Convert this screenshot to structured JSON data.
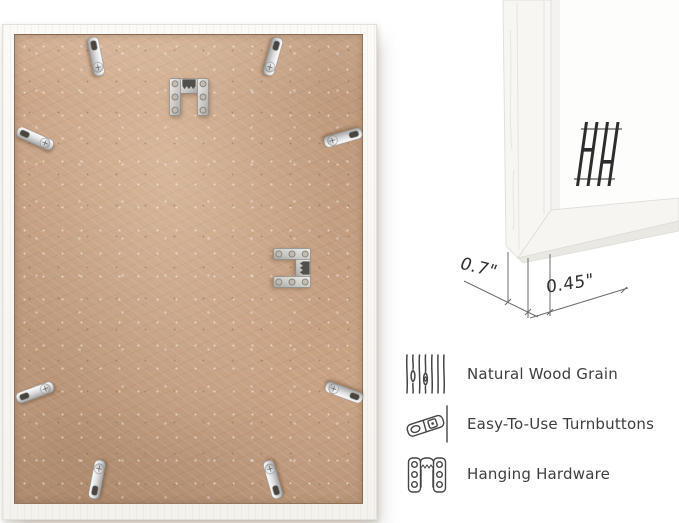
{
  "page": {
    "background": "#ffffff"
  },
  "frame_back": {
    "board_color": "#c9a284",
    "frame_color": "#f7f6f2",
    "turnbutton_count": 8,
    "hanger_count": 2
  },
  "corner_detail": {
    "depth_dimension": "0.7\"",
    "face_dimension": "0.45\"",
    "brand_logo": "HH"
  },
  "features": {
    "items": [
      {
        "icon": "wood-grain-icon",
        "label": "Natural Wood Grain"
      },
      {
        "icon": "turnbutton-icon",
        "label": "Easy-To-Use Turnbuttons"
      },
      {
        "icon": "hanging-hardware-icon",
        "label": "Hanging Hardware"
      }
    ]
  },
  "colors": {
    "text": "#3e3e3e",
    "line": "#6b6b6b",
    "metal": "#c9c9c9",
    "logo": "#2d2d2d"
  }
}
